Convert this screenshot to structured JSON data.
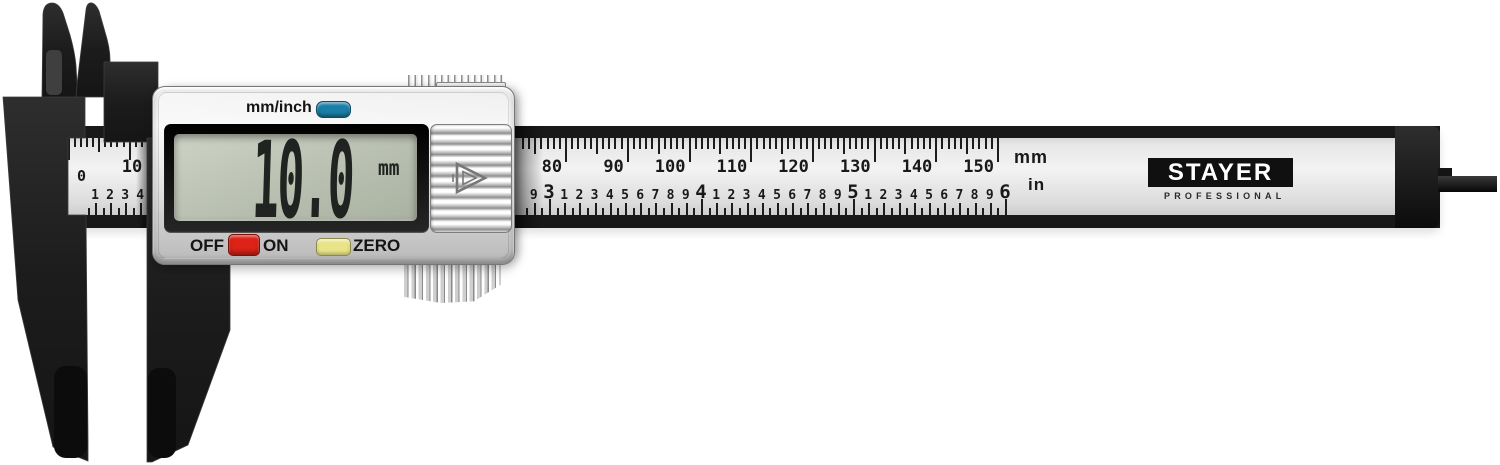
{
  "device": {
    "mode_label": "mm/inch",
    "off_label": "OFF",
    "on_label": "ON",
    "zero_label": "ZERO",
    "lcd_value": "10.0",
    "lcd_unit": "mm"
  },
  "brand": {
    "name": "STAYER",
    "tagline": "PROFESSIONAL"
  },
  "scale": {
    "mm_unit_label": "mm",
    "in_unit_label": "in",
    "window_mm_labels": [
      "0",
      "10"
    ],
    "window_in_labels": [
      "1",
      "2",
      "3",
      "4"
    ],
    "main_mm_labels": [
      "80",
      "90",
      "100",
      "110",
      "120",
      "130",
      "140",
      "150"
    ],
    "main_in_major_labels": [
      "3",
      "4",
      "5",
      "6"
    ],
    "main_in_minor_labels": [
      "1",
      "2",
      "3",
      "4",
      "5",
      "6",
      "7",
      "8",
      "9"
    ]
  },
  "colors": {
    "mode_button": "#1b7ea6",
    "power_button": "#dd2317",
    "zero_button": "#eae489",
    "lcd_background": "#bcc3b4"
  }
}
